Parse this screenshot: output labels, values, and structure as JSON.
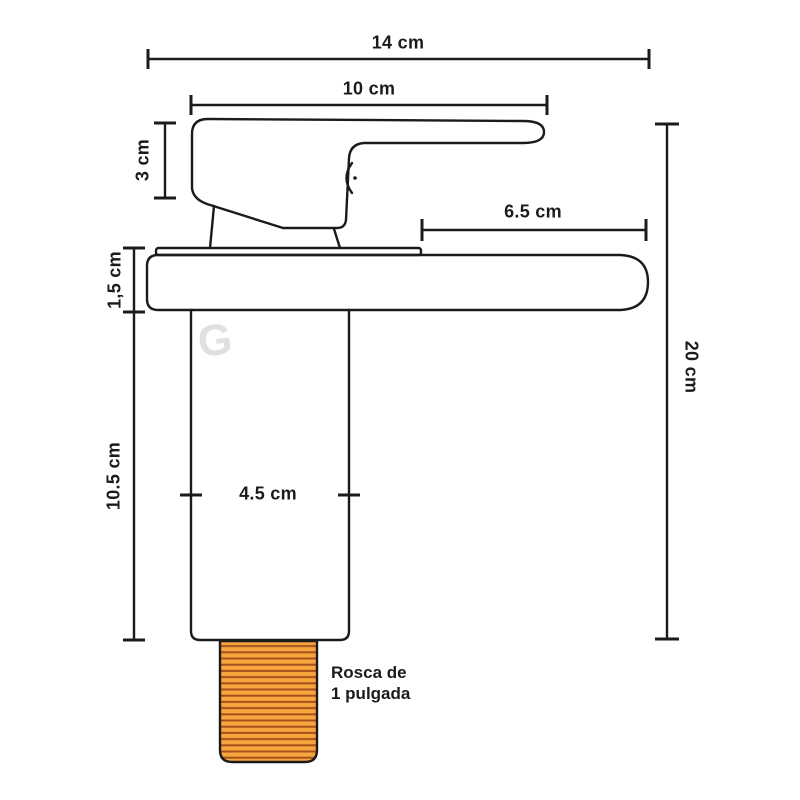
{
  "diagram": {
    "subject": "faucet-technical-drawing"
  },
  "dimensions": {
    "overall_width": {
      "text": "14 cm"
    },
    "handle_length": {
      "text": "10 cm"
    },
    "handle_height": {
      "text": "3 cm"
    },
    "spout_reach": {
      "text": "6.5 cm"
    },
    "plate_thickness": {
      "text": "1,5 cm"
    },
    "body_height": {
      "text": "10.5 cm"
    },
    "body_width": {
      "text": "4.5 cm"
    },
    "overall_height": {
      "text": "20 cm"
    }
  },
  "annotations": {
    "thread_note_line1": "Rosca de",
    "thread_note_line2": "1 pulgada"
  },
  "watermark": {
    "letter": "G"
  },
  "colors": {
    "line": "#1B1B1B",
    "thread_fill": "#F7A53C",
    "thread_stripe": "#A3501D",
    "watermark": "#E0E0E0",
    "background": "#FFFFFF"
  }
}
